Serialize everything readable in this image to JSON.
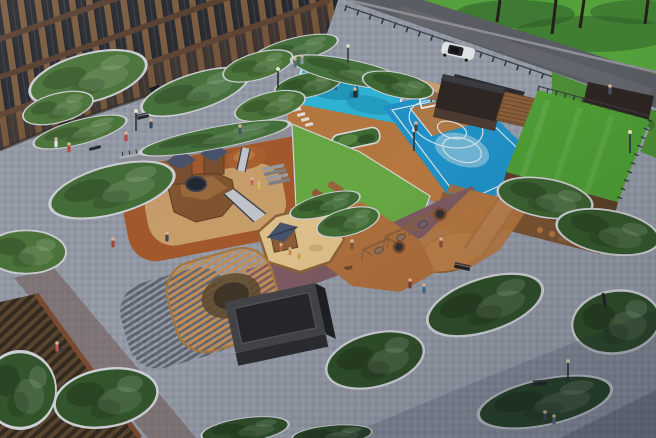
{
  "scene": {
    "title": "Aerial 3D render of a residential courtyard with playgrounds and sports areas",
    "view": "aerial-oblique",
    "time_of_day": "daytime"
  },
  "colors": {
    "paving": "#939aa6",
    "paving_shadow": "#16202f",
    "road": "#5a5d64",
    "grass": "#55a23c",
    "grass_shade": "#2c5b28",
    "roof_lawn": "#4f9e36",
    "lawn": "#67a743",
    "splash": "#2db4d6",
    "splash_dark": "#1b8cae",
    "court": "#2191c6",
    "court_line": "#e3ecee",
    "track": "#b5773f",
    "terracotta": "#a4582c",
    "playground_inner": "#c89e6a",
    "sand": "#ddbf8a",
    "purple": "#7c5a62",
    "bush": "#4a7338",
    "bush_dark": "#2f4e2a",
    "curb": "#d4d6da",
    "brick_pier": "#7b5b3d",
    "window": "#23262c",
    "wood": "#c08d58",
    "wood_dark": "#7a5433",
    "wall_wood": "#5d4028",
    "shed": "#434449",
    "slate": "#47536b",
    "metal": "#c2c6cc",
    "car": "#e2e5e7",
    "pavilion": "#2e2622"
  },
  "objects": {
    "building": "apartment building facade",
    "building_roof": "low building roof with wooden ribs",
    "road": "access road",
    "car": "white SUV on road",
    "grove": "lawn with trees beyond road",
    "shelter": "wooden street shelter",
    "outdoor_gym": "blue outdoor workout pad",
    "basketball_court": "blue basketball court",
    "sports_pavilion": "dark sports pavilion",
    "green_roof": "play hill with green roof lawn",
    "wide_slide": "wide metal hill slide",
    "bleachers": "wooden bleacher steps",
    "castle_playground": "terracotta playground with wooden castle",
    "castle": "wooden castle fort with slate roofs",
    "hill_slide": "small mound slide",
    "sand_playground": "sand pit with play hut",
    "pergola": "wooden lattice pergola",
    "shed": "dark utility shed",
    "swings": "A-frame nest swings on purple path",
    "loungers": "wooden sun loungers on lawn",
    "planters": "curbed greenery islands",
    "people": "residents walking in courtyard"
  }
}
